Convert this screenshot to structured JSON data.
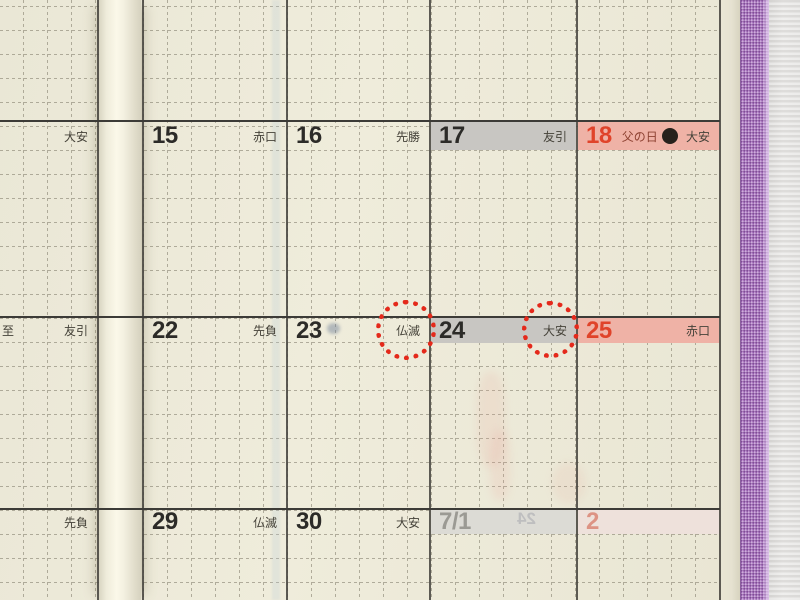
{
  "colors": {
    "paper": "#ece9d8",
    "backdrop_gray": "#e3e2e1",
    "cover_purple": "#ae7dc2",
    "cover_highlight": "#ebd7f6",
    "band_saturday_gray": "#c8c6c2",
    "band_sunday_pink": "#efb2a6",
    "band_next_month_gray": "#dcdbd5",
    "band_next_month_pink": "#eee1db",
    "date_dark": "#2c2b28",
    "date_red": "#e0432a",
    "date_faded_gray": "#9b9a94",
    "date_faded_red": "#dd9384",
    "rokuyo_text": "#454239",
    "fathers_day_text": "#8e4232",
    "marker_circle_red": "#e4291b"
  },
  "calendar": {
    "rows": [
      {
        "left": {
          "sub": "",
          "rokuyo": "大安"
        },
        "cells": [
          {
            "date": "15",
            "rokuyo": "赤口"
          },
          {
            "date": "16",
            "rokuyo": "先勝"
          },
          {
            "date": "17",
            "rokuyo": "友引"
          },
          {
            "date": "18",
            "note": "父の日",
            "moon": "new-moon",
            "rokuyo": "大安"
          }
        ]
      },
      {
        "left": {
          "sub": "至",
          "rokuyo": "友引"
        },
        "cells": [
          {
            "date": "22",
            "rokuyo": "先負"
          },
          {
            "date": "23",
            "rokuyo": "仏滅",
            "circled": true
          },
          {
            "date": "24",
            "rokuyo": "大安",
            "circled": true
          },
          {
            "date": "25",
            "rokuyo": "赤口"
          }
        ]
      },
      {
        "left": {
          "sub": "",
          "rokuyo": "先負"
        },
        "cells": [
          {
            "date": "29",
            "rokuyo": "仏滅"
          },
          {
            "date": "30",
            "rokuyo": "大安"
          },
          {
            "date": "7/1",
            "rokuyo": "",
            "ghost": "24"
          },
          {
            "date": "2",
            "rokuyo": ""
          }
        ]
      }
    ]
  }
}
